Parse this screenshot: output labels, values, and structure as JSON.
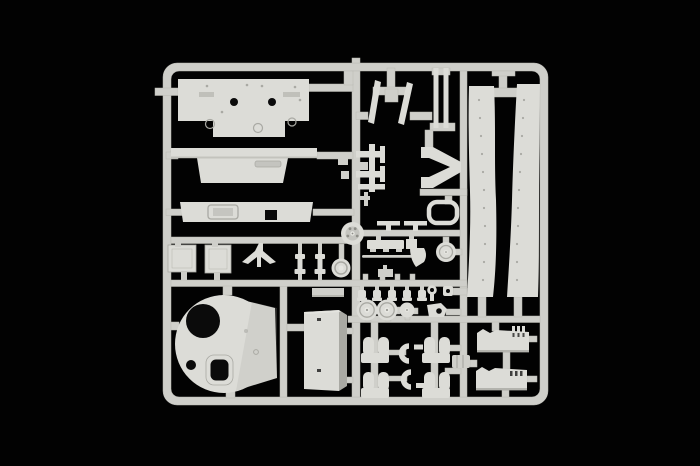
{
  "canvas": {
    "width": 700,
    "height": 466
  },
  "scene": {
    "description": "light grey injection-molded model kit sprue with tank parts, photographed on a black background"
  },
  "colors": {
    "background": "#020202",
    "plastic": "#cfcfca",
    "plastic_bright": "#dcdcd7",
    "plastic_mid": "#c4c4bf",
    "plastic_shadow": "#a9a9a3",
    "plastic_dark": "#8e8e88",
    "hole": "#0b0b0b"
  },
  "sprue": {
    "parts": [
      "hull-top-plate",
      "glacis-plate",
      "hull-rear-plate",
      "turret-roof",
      "stowage-bin",
      "hatch-panel-left",
      "hatch-panel-right",
      "mg-mount",
      "shock-absorber-1",
      "shock-absorber-2",
      "idler-disc",
      "drive-sprocket",
      "road-wheel-1",
      "road-wheel-2",
      "road-wheel-3",
      "fender-left",
      "fender-right",
      "muffler-box-1",
      "muffler-box-2",
      "exhaust-elbow-1",
      "exhaust-elbow-2",
      "bogie-1",
      "bogie-2",
      "bogie-3",
      "bogie-4",
      "leaf-spring-1",
      "leaf-spring-2",
      "barrel-rod-1",
      "barrel-rod-2",
      "gun-cradle",
      "hatch-ring",
      "tool-shovel",
      "engine-hatch",
      "towing-eyelet",
      "clamp-brackets",
      "bolt-caps"
    ]
  }
}
